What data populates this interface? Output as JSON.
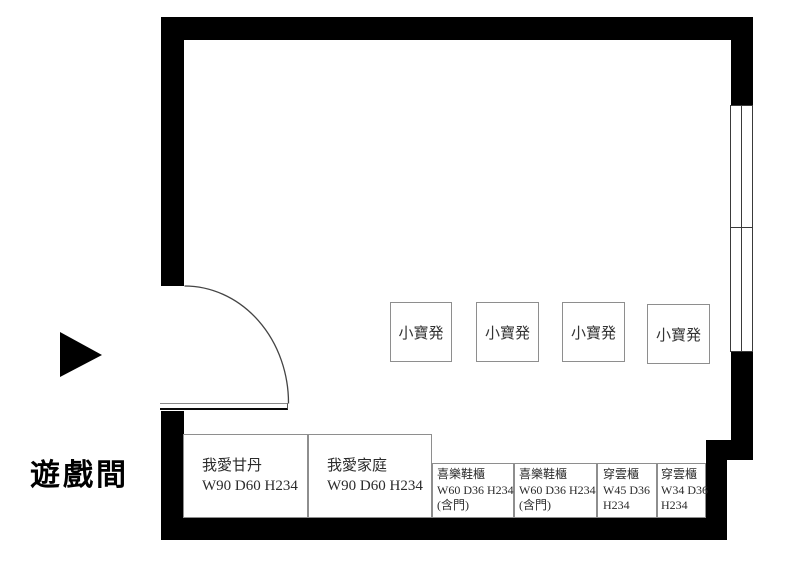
{
  "room": {
    "label": "遊戲間"
  },
  "icons": {
    "direction_arrow": "▶"
  },
  "stools": [
    {
      "label": "小寶発"
    },
    {
      "label": "小寶発"
    },
    {
      "label": "小寶発"
    },
    {
      "label": "小寶発"
    }
  ],
  "cabinets": [
    {
      "lines": [
        "我愛甘丹",
        "W90 D60 H234"
      ]
    },
    {
      "lines": [
        "我愛家庭",
        "W90 D60 H234"
      ]
    },
    {
      "lines": [
        "喜樂鞋櫃",
        "W60 D36 H234",
        "(含門)"
      ]
    },
    {
      "lines": [
        "喜樂鞋櫃",
        "W60 D36 H234",
        "(含門)"
      ]
    },
    {
      "lines": [
        "穿雲櫃",
        "W45 D36",
        "H234"
      ]
    },
    {
      "lines": [
        "穿雲櫃",
        "W34 D36",
        "H234"
      ]
    }
  ],
  "colors": {
    "wall": "#000000",
    "furniture_border": "#8e8e8e",
    "label_text": "#2b2b2b"
  }
}
